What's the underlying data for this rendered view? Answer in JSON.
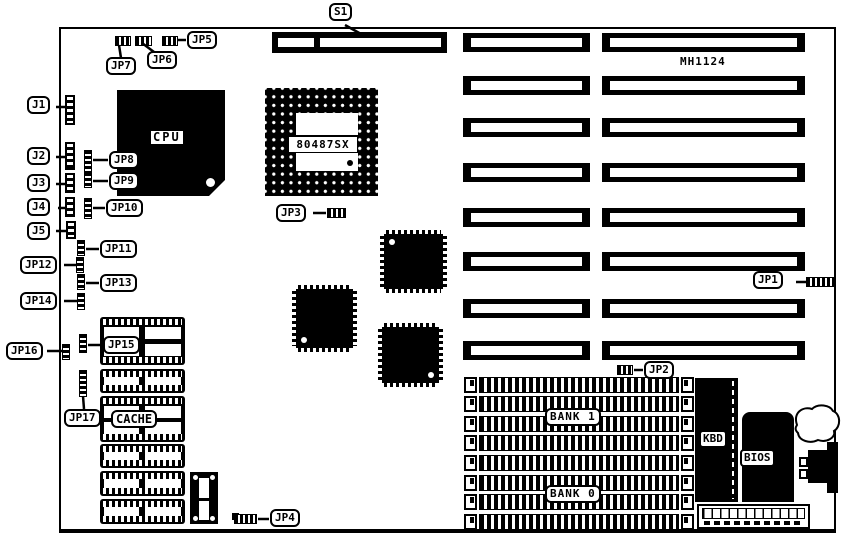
{
  "diagram": {
    "board_model": "MH1124",
    "callouts": {
      "s1": "S1",
      "j1": "J1",
      "j2": "J2",
      "j3": "J3",
      "j4": "J4",
      "j5": "J5",
      "jp1": "JP1",
      "jp2": "JP2",
      "jp3": "JP3",
      "jp4": "JP4",
      "jp5": "JP5",
      "jp6": "JP6",
      "jp7": "JP7",
      "jp8": "JP8",
      "jp9": "JP9",
      "jp10": "JP10",
      "jp11": "JP11",
      "jp12": "JP12",
      "jp13": "JP13",
      "jp14": "JP14",
      "jp15": "JP15",
      "jp16": "JP16",
      "jp17": "JP17"
    },
    "components": {
      "cpu": "CPU",
      "coprocessor_socket": "80487SX",
      "cache": "CACHE",
      "memory_bank_1": "BANK 1",
      "memory_bank_0": "BANK 0",
      "keyboard_controller": "KBD",
      "bios": "BIOS"
    },
    "colors": {
      "ink": "#000000",
      "paper": "#ffffff"
    }
  }
}
